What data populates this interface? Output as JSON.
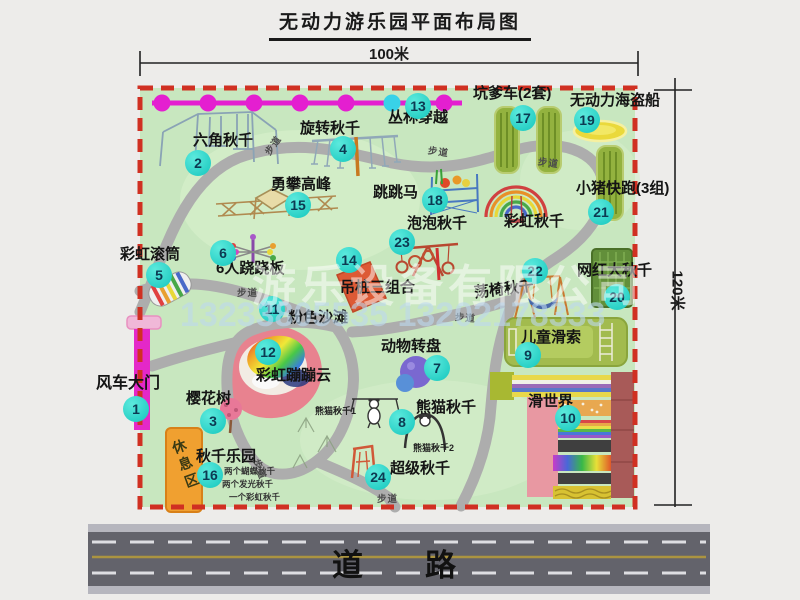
{
  "title": "无动力游乐园平面布局图",
  "dimensions": {
    "top": "100米",
    "right": "120米"
  },
  "road_label": "道路",
  "trail_label": "步道",
  "rest_area": "休息区",
  "watermark": {
    "company": "游乐设备有限公司",
    "phone": "13233805535 13202178333"
  },
  "colors": {
    "map_green": "#c8e7bf",
    "border_red": "#d03022",
    "marker_teal": "#15c6bd",
    "magenta_line": "#e41fd0",
    "road_gray": "#63636b",
    "rest_orange": "#f0a030"
  },
  "attractions": {
    "windmill_gate": {
      "num": "1",
      "name": "风车大门"
    },
    "hex_swing": {
      "num": "2",
      "name": "六角秋千"
    },
    "cherry_tree": {
      "num": "3",
      "name": "樱花树"
    },
    "rotate_swing": {
      "num": "4",
      "name": "旋转秋千"
    },
    "rainbow_roller": {
      "num": "5",
      "name": "彩虹滚筒"
    },
    "seesaw6": {
      "num": "6",
      "name": "6人跷跷板"
    },
    "animal_turntable": {
      "num": "7",
      "name": "动物转盘"
    },
    "panda_swing": {
      "num": "8",
      "name": "熊猫秋千",
      "sub1": "熊猫秋千1",
      "sub2": "熊猫秋千2"
    },
    "kids_zipline": {
      "num": "9",
      "name": "儿童滑索"
    },
    "slide_world": {
      "num": "10",
      "name": "滑世界"
    },
    "pink_beach": {
      "num": "11",
      "name": "粉色沙滩"
    },
    "rainbow_cloud": {
      "num": "12",
      "name": "彩虹蹦蹦云"
    },
    "jungle_cross": {
      "num": "13",
      "name": "丛林穿越"
    },
    "hanging_combo": {
      "num": "14",
      "name": "吊桩三组合"
    },
    "climb_peak": {
      "num": "15",
      "name": "勇攀高峰"
    },
    "swing_park": {
      "num": "16",
      "name": "秋千乐园",
      "notes": [
        "两个蝴蝶秋千",
        "两个发光秋千",
        "一个彩虹秋千"
      ]
    },
    "pit_car": {
      "num": "17",
      "name": "坑爹车(2套)"
    },
    "jump_horse": {
      "num": "18",
      "name": "跳跳马"
    },
    "pirate_ship": {
      "num": "19",
      "name": "无动力海盗船"
    },
    "big_swing": {
      "num": "20",
      "name": "网红大秋千"
    },
    "piggy_run": {
      "num": "21",
      "name": "小猪快跑(3组)"
    },
    "chair_swing": {
      "num": "22",
      "name": "荡椅秋千"
    },
    "bubble_swing": {
      "num": "23",
      "name": "泡泡秋千"
    },
    "super_swing": {
      "num": "24",
      "name": "超级秋千"
    },
    "rainbow_swing": {
      "name": "彩虹秋千"
    }
  }
}
